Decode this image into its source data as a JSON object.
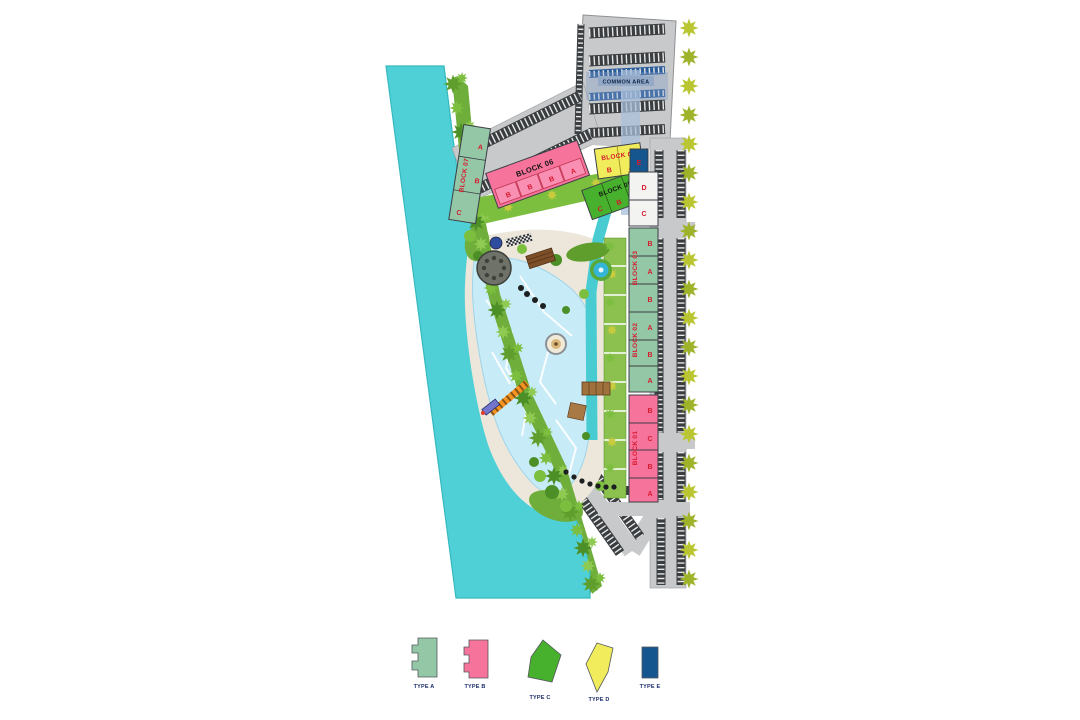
{
  "map": {
    "common_area_label": "COMMON AREA",
    "blocks": {
      "block01": {
        "name": "BLOCK 01",
        "units": [
          "B",
          "C",
          "B",
          "A"
        ]
      },
      "block02": {
        "name": "BLOCK 02",
        "units": [
          "A",
          "B",
          "A"
        ]
      },
      "block03": {
        "name": "BLOCK 03",
        "units": [
          "B",
          "A",
          "B"
        ]
      },
      "block04": {
        "name": "BLOCK 04",
        "units": [
          "B",
          "A"
        ]
      },
      "block05": {
        "name": "BLOCK 05",
        "units": [
          "C",
          "B",
          "A"
        ]
      },
      "block06": {
        "name": "BLOCK 06",
        "units": [
          "B",
          "B",
          "B",
          "A"
        ]
      },
      "block07": {
        "name": "BLOCK 07",
        "units": [
          "A",
          "B",
          "C"
        ]
      },
      "type_e_unit": "E",
      "row_units": [
        "D",
        "C"
      ]
    }
  },
  "legend": {
    "items": [
      {
        "label": "TYPE A",
        "color": "#93c7a6"
      },
      {
        "label": "TYPE B",
        "color": "#f6739c"
      },
      {
        "label": "TYPE C",
        "color": "#47b02c"
      },
      {
        "label": "TYPE D",
        "color": "#f0ec5c"
      },
      {
        "label": "TYPE E",
        "color": "#15568f"
      }
    ]
  },
  "colors": {
    "water": "#4fd0d6",
    "pool": "#c8ebf8",
    "road": "#c7c9cb",
    "parking_stall": "#3a3e41",
    "greenery": "#6fae3a",
    "tree_yellow": "#b9c531",
    "sand": "#ece7da",
    "accent_red": "#d81a2e",
    "label_navy": "#1b2d6b"
  }
}
